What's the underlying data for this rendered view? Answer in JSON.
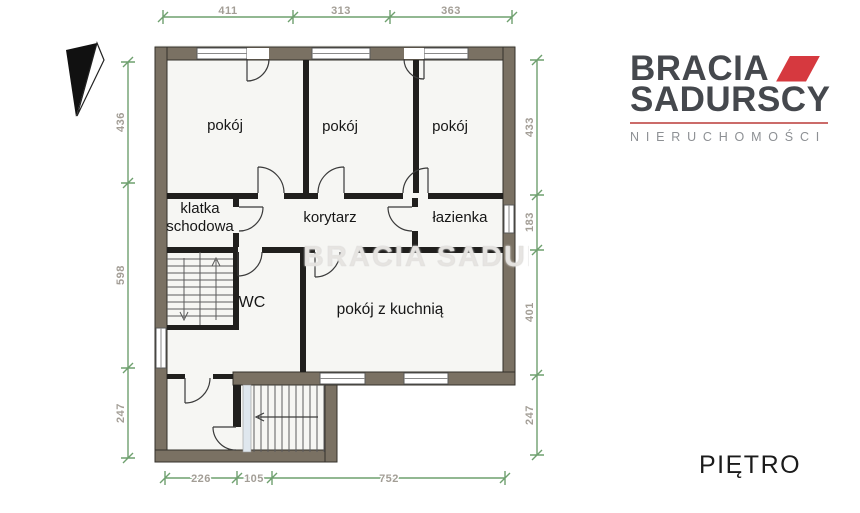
{
  "logo": {
    "brand_line1": "BRACIA",
    "brand_line2": "SADURSCY",
    "tagline": "NIERUCHOMOŚCI",
    "accent_color": "#d6393f",
    "text_color": "#45484d"
  },
  "floor_label": "PIĘTRO",
  "watermark_text": "BRACIA SADURSCY",
  "rooms": {
    "room1": "pokój",
    "room2": "pokój",
    "room3": "pokój",
    "staircase_line1": "klatka",
    "staircase_line2": "schodowa",
    "corridor": "korytarz",
    "bathroom": "łazienka",
    "wc": "WC",
    "kitchen_room": "pokój z kuchnią"
  },
  "dimensions": {
    "top": [
      "411",
      "313",
      "363"
    ],
    "bottom": [
      "226",
      "105",
      "752"
    ],
    "left": [
      "436",
      "598",
      "247"
    ],
    "right": [
      "433",
      "183",
      "401",
      "247"
    ]
  },
  "colors": {
    "wall_fill": "#7a7163",
    "interior_wall": "#201f1d",
    "dimension_line": "#6fa06f",
    "dimension_text": "#a39e96"
  }
}
